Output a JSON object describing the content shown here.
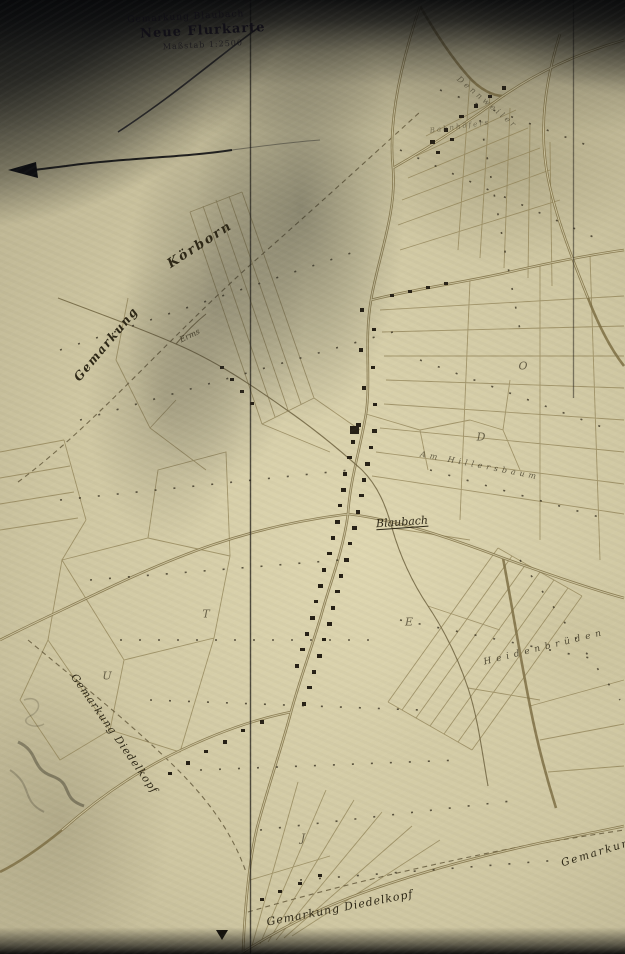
{
  "title_block": {
    "line1": "Gemarkung Blaubach",
    "line2": "Neue Flurkarte",
    "line3": "Maßstab 1:2500"
  },
  "map_labels": {
    "koerborn": "Körborn",
    "gemarkung_left": "Gemarkung",
    "erms": "Erms",
    "village": "Blaubach",
    "am_hillersbaum": "Am Hillersbaum",
    "heidenbroeden": "Heidenbrüden",
    "gemarkung_diedelkopf_left": "Gemarkung Diedelkopf",
    "gemarkung_diedelkopf_bottom": "Gemarkung Diedelkopf",
    "gemarkung_bottom_right": "Gemarkung",
    "road_dennweiler": "Dennweiler",
    "bahnhoefers": "Bahnhöfers"
  },
  "section_letters": [
    {
      "ch": "O"
    },
    {
      "ch": "D"
    },
    {
      "ch": "E"
    },
    {
      "ch": "T"
    },
    {
      "ch": "U"
    },
    {
      "ch": "J"
    }
  ],
  "colors": {
    "paper": "#cfc7a3",
    "map_ink": "#8a7b4e",
    "building_ink": "#262015",
    "text_ink": "#2e2817",
    "shadow": "#0b0c0e"
  }
}
